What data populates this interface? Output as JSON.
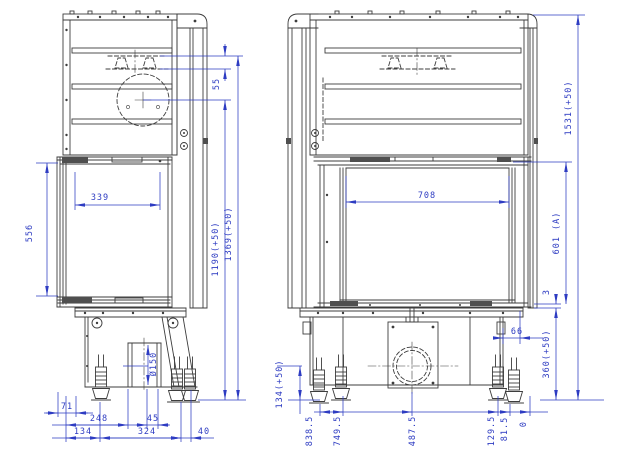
{
  "colors": {
    "background": "#ffffff",
    "line": "#3d3d3d",
    "dimension": "#2e3cc2"
  },
  "side_view": {
    "dims": {
      "damper_drop": "55",
      "glass_depth": "339",
      "door_height": "556",
      "flue_axis_height": "1190(+50)",
      "damper_height": "1369(+50)",
      "duct_diameter": "Ø150",
      "front_offset": "71",
      "duct_front_distance": "248",
      "duct_offset": "45",
      "foot_front_distance": "134",
      "foot_spacing": "324",
      "rear_overhang": "40"
    }
  },
  "front_view": {
    "dims": {
      "total_height": "1531(+50)",
      "glass_width": "708",
      "glass_height": "601 (A)",
      "sill_gap": "3",
      "side_clearance": "66",
      "plinth_height": "360(+50)",
      "air_axis_height": "134(+50)",
      "datums": [
        "838.5",
        "749.5",
        "487.5",
        "129.5",
        "81.5",
        "0"
      ]
    }
  }
}
